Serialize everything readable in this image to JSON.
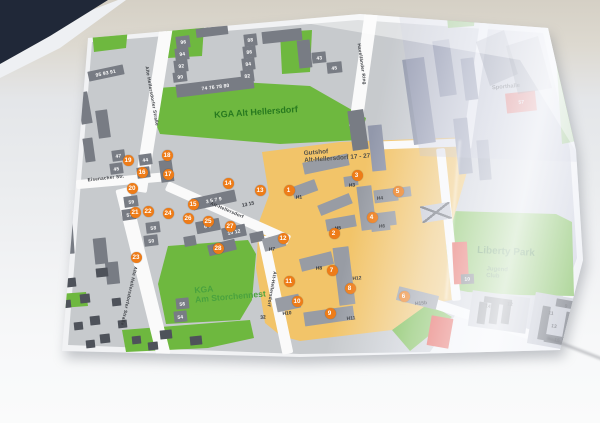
{
  "map": {
    "colors": {
      "building": "#787c84",
      "building_dark": "#4e525a",
      "building_on_yellow": "#989ca4",
      "building_bluish": "#9298ab",
      "block_lavender": "#b9bcc6",
      "red_building": "#e23a2e",
      "crossed_building": "#c3c6d0",
      "green_area": "#6eb83f",
      "yellow_area": "#f2c469",
      "marker_orange": "#ee7c18",
      "road_white": "#fafafa",
      "base_gray": "#c8cbd0"
    },
    "area_labels": [
      {
        "id": "kga-alt-hellersdorf",
        "lines": [
          "KGA Alt Hellersdorf"
        ],
        "x": 256,
        "y": 112,
        "rot": -4,
        "size": 9,
        "scale": 1,
        "color": "#27791f"
      },
      {
        "id": "kga-am-storchennest",
        "lines": [
          "KGA",
          "Am Storchennest"
        ],
        "x": 230,
        "y": 292,
        "rot": -5,
        "size": 9,
        "scale": 0.95,
        "color": "#4aa23e"
      },
      {
        "id": "liberty-park",
        "lines": [
          "Liberty Park"
        ],
        "x": 506,
        "y": 252,
        "rot": 3,
        "size": 10,
        "scale": 1,
        "color": "#1d6b17"
      },
      {
        "id": "jugend-club",
        "lines": [
          "Jugend",
          "Club"
        ],
        "x": 497,
        "y": 273,
        "rot": 3,
        "size": 8,
        "scale": 0.75,
        "color": "#2f6e2a"
      },
      {
        "id": "gutshof",
        "lines": [
          "Gutshof",
          "Alt-Hellersdorf 17 - 27"
        ],
        "x": 337,
        "y": 155,
        "rot": -4,
        "size": 8,
        "scale": 0.8,
        "color": "#54524a"
      },
      {
        "id": "sporthalle",
        "lines": [
          "Sporthalle"
        ],
        "x": 506,
        "y": 87,
        "rot": -5,
        "size": 8,
        "scale": 0.72,
        "color": "#3a3d43"
      }
    ],
    "street_labels": [
      {
        "text": "Alte Hellersdorfer Straße",
        "x": 152,
        "y": 96,
        "rot": 80
      },
      {
        "text": "Alte Hellersdorfer Straße",
        "x": 129,
        "y": 296,
        "rot": 103
      },
      {
        "text": "Eisenacher Str.",
        "x": 106,
        "y": 178,
        "rot": -6
      },
      {
        "text": "Alt-Hellersdorf",
        "x": 227,
        "y": 210,
        "rot": 23
      },
      {
        "text": "Alt-Hellersdorf",
        "x": 272,
        "y": 289,
        "rot": 100
      },
      {
        "text": "Havelländer Ring",
        "x": 362,
        "y": 64,
        "rot": 82
      }
    ],
    "markers": [
      [
        1,
        289,
        190
      ],
      [
        2,
        334,
        233
      ],
      [
        3,
        357,
        175
      ],
      [
        4,
        372,
        217
      ],
      [
        5,
        398,
        191
      ],
      [
        6,
        404,
        296
      ],
      [
        7,
        332,
        270
      ],
      [
        8,
        350,
        288
      ],
      [
        9,
        330,
        313
      ],
      [
        10,
        297,
        301
      ],
      [
        11,
        289,
        281
      ],
      [
        12,
        283,
        238
      ],
      [
        13,
        260,
        190
      ],
      [
        14,
        228,
        183
      ],
      [
        15,
        193,
        204
      ],
      [
        16,
        142,
        172
      ],
      [
        17,
        168,
        174
      ],
      [
        18,
        167,
        155
      ],
      [
        19,
        128,
        160
      ],
      [
        20,
        132,
        188
      ],
      [
        21,
        135,
        212
      ],
      [
        22,
        148,
        211
      ],
      [
        23,
        136,
        257
      ],
      [
        24,
        168,
        213
      ],
      [
        25,
        208,
        221
      ],
      [
        26,
        188,
        218
      ],
      [
        27,
        230,
        226
      ],
      [
        28,
        218,
        248
      ]
    ],
    "number_labels": [
      [
        "13 15",
        248,
        204,
        -12
      ],
      [
        "32",
        263,
        317,
        -4
      ],
      [
        "14",
        488,
        306,
        8
      ],
      [
        "12",
        510,
        304,
        8
      ],
      [
        "9",
        566,
        306,
        10
      ],
      [
        "11",
        551,
        313,
        10
      ],
      [
        "13",
        554,
        326,
        10
      ],
      [
        "15",
        557,
        340,
        10
      ],
      [
        "H1",
        299,
        197,
        -5
      ],
      [
        "H3",
        352,
        185,
        -5
      ],
      [
        "H4",
        380,
        198,
        -5
      ],
      [
        "H5",
        338,
        228,
        -5
      ],
      [
        "H6",
        382,
        226,
        -5
      ],
      [
        "H7",
        272,
        249,
        -5
      ],
      [
        "H8",
        319,
        268,
        -5
      ],
      [
        "H12",
        357,
        278,
        -5
      ],
      [
        "H10",
        287,
        313,
        -5
      ],
      [
        "H11",
        351,
        318,
        -5
      ],
      [
        "H15b",
        421,
        303,
        -5
      ]
    ],
    "buildings": [
      [
        176,
        36,
        14,
        12,
        -7,
        "b",
        "96"
      ],
      [
        175,
        48,
        14,
        12,
        -7,
        "b",
        "94"
      ],
      [
        174,
        60,
        14,
        12,
        -7,
        "b",
        "92"
      ],
      [
        173,
        72,
        14,
        10,
        -7,
        "b",
        "90"
      ],
      [
        176,
        80,
        78,
        13,
        -7,
        "b",
        "74 76 78 80"
      ],
      [
        244,
        34,
        13,
        12,
        -7,
        "b",
        "88"
      ],
      [
        243,
        46,
        13,
        12,
        -7,
        "b",
        "86"
      ],
      [
        242,
        58,
        13,
        12,
        -7,
        "b",
        "84"
      ],
      [
        241,
        70,
        13,
        12,
        -7,
        "b",
        "82"
      ],
      [
        196,
        27,
        32,
        9,
        -7,
        "b"
      ],
      [
        262,
        30,
        40,
        12,
        -6,
        "b"
      ],
      [
        298,
        40,
        13,
        28,
        -6,
        "b"
      ],
      [
        88,
        68,
        36,
        10,
        -12,
        "b",
        "95 93 91"
      ],
      [
        79,
        92,
        11,
        32,
        -10,
        "b"
      ],
      [
        97,
        110,
        12,
        28,
        -8,
        "b"
      ],
      [
        84,
        138,
        10,
        24,
        -8,
        "b"
      ],
      [
        112,
        150,
        13,
        11,
        -8,
        "b",
        "47"
      ],
      [
        110,
        163,
        13,
        11,
        -8,
        "b",
        "45"
      ],
      [
        139,
        154,
        13,
        11,
        -8,
        "b",
        "44"
      ],
      [
        137,
        167,
        13,
        11,
        -8,
        "b",
        "62"
      ],
      [
        160,
        160,
        13,
        22,
        -8,
        "b"
      ],
      [
        124,
        196,
        14,
        11,
        -8,
        "b",
        "59"
      ],
      [
        122,
        209,
        14,
        11,
        -8,
        "b",
        "57"
      ],
      [
        146,
        222,
        14,
        11,
        -7,
        "b",
        "58"
      ],
      [
        144,
        235,
        14,
        11,
        -7,
        "b",
        "50"
      ],
      [
        176,
        298,
        13,
        11,
        -6,
        "b",
        "56"
      ],
      [
        174,
        311,
        13,
        11,
        -6,
        "b",
        "54"
      ],
      [
        192,
        194,
        44,
        12,
        -12,
        "b",
        "3 5 7 9"
      ],
      [
        196,
        220,
        24,
        12,
        -11,
        "b",
        "6 8"
      ],
      [
        222,
        226,
        24,
        12,
        -12,
        "b",
        "10 12"
      ],
      [
        250,
        232,
        14,
        10,
        -12,
        "b"
      ],
      [
        208,
        242,
        28,
        11,
        -14,
        "b"
      ],
      [
        184,
        236,
        12,
        10,
        -10,
        "b"
      ],
      [
        60,
        206,
        13,
        48,
        -4,
        "b"
      ],
      [
        94,
        238,
        13,
        26,
        -6,
        "b"
      ],
      [
        106,
        262,
        13,
        22,
        -6,
        "b"
      ],
      [
        66,
        278,
        10,
        9,
        -6,
        "d"
      ],
      [
        80,
        294,
        10,
        9,
        -6,
        "d"
      ],
      [
        62,
        300,
        9,
        8,
        -6,
        "d"
      ],
      [
        90,
        316,
        10,
        9,
        -6,
        "d"
      ],
      [
        74,
        322,
        9,
        8,
        -6,
        "d"
      ],
      [
        100,
        334,
        10,
        9,
        -6,
        "d"
      ],
      [
        86,
        340,
        9,
        8,
        -6,
        "d"
      ],
      [
        58,
        256,
        10,
        9,
        -6,
        "d"
      ],
      [
        96,
        268,
        12,
        9,
        -6,
        "d"
      ],
      [
        112,
        298,
        9,
        8,
        -6,
        "d"
      ],
      [
        118,
        320,
        9,
        8,
        -6,
        "d"
      ],
      [
        132,
        336,
        9,
        8,
        -6,
        "d"
      ],
      [
        148,
        342,
        10,
        8,
        -6,
        "d"
      ],
      [
        54,
        234,
        9,
        8,
        -6,
        "d"
      ],
      [
        160,
        330,
        12,
        9,
        -6,
        "d"
      ],
      [
        190,
        336,
        12,
        9,
        -6,
        "d"
      ],
      [
        312,
        52,
        14,
        11,
        -6,
        "b",
        "43"
      ],
      [
        327,
        62,
        15,
        11,
        -6,
        "b",
        "45"
      ],
      [
        350,
        110,
        16,
        40,
        -8,
        "b"
      ],
      [
        303,
        158,
        46,
        12,
        -12,
        "y"
      ],
      [
        344,
        176,
        14,
        10,
        -8,
        "y"
      ],
      [
        359,
        186,
        15,
        44,
        -7,
        "y"
      ],
      [
        374,
        189,
        24,
        13,
        -7,
        "y"
      ],
      [
        376,
        212,
        20,
        14,
        -7,
        "y"
      ],
      [
        292,
        183,
        25,
        12,
        -20,
        "y"
      ],
      [
        318,
        199,
        34,
        11,
        -22,
        "y"
      ],
      [
        326,
        217,
        30,
        12,
        -10,
        "y"
      ],
      [
        371,
        219,
        19,
        12,
        -7,
        "y"
      ],
      [
        263,
        236,
        22,
        13,
        -16,
        "y"
      ],
      [
        300,
        255,
        33,
        13,
        -14,
        "y"
      ],
      [
        336,
        247,
        16,
        58,
        -7,
        "y"
      ],
      [
        276,
        296,
        24,
        14,
        -12,
        "y"
      ],
      [
        304,
        309,
        50,
        14,
        -8,
        "y"
      ],
      [
        397,
        291,
        41,
        14,
        14,
        "y"
      ],
      [
        398,
        187,
        13,
        10,
        -7,
        "y"
      ],
      [
        408,
        58,
        22,
        86,
        -8,
        "g"
      ],
      [
        436,
        40,
        17,
        56,
        -8,
        "g"
      ],
      [
        463,
        58,
        13,
        42,
        -7,
        "g"
      ],
      [
        456,
        118,
        14,
        56,
        -6,
        "g"
      ],
      [
        478,
        140,
        12,
        40,
        -5,
        "g"
      ],
      [
        370,
        125,
        14,
        46,
        -6,
        "g"
      ],
      [
        421,
        204,
        30,
        17,
        -9,
        "x"
      ],
      [
        470,
        294,
        58,
        36,
        8,
        "l"
      ],
      [
        478,
        302,
        8,
        22,
        8,
        "d"
      ],
      [
        490,
        303,
        8,
        21,
        8,
        "d"
      ],
      [
        502,
        304,
        8,
        20,
        8,
        "d"
      ],
      [
        484,
        298,
        28,
        6,
        8,
        "d"
      ],
      [
        531,
        296,
        52,
        52,
        10,
        "l"
      ],
      [
        540,
        306,
        8,
        34,
        10,
        "d"
      ],
      [
        556,
        300,
        20,
        8,
        10,
        "d"
      ],
      [
        564,
        312,
        8,
        30,
        10,
        "d"
      ],
      [
        544,
        336,
        26,
        8,
        10,
        "d"
      ],
      [
        506,
        92,
        30,
        20,
        -6,
        "r",
        "57"
      ],
      [
        453,
        242,
        15,
        42,
        -3,
        "r"
      ],
      [
        429,
        317,
        22,
        30,
        10,
        "r"
      ],
      [
        461,
        274,
        13,
        10,
        -3,
        "d",
        "10"
      ]
    ]
  }
}
